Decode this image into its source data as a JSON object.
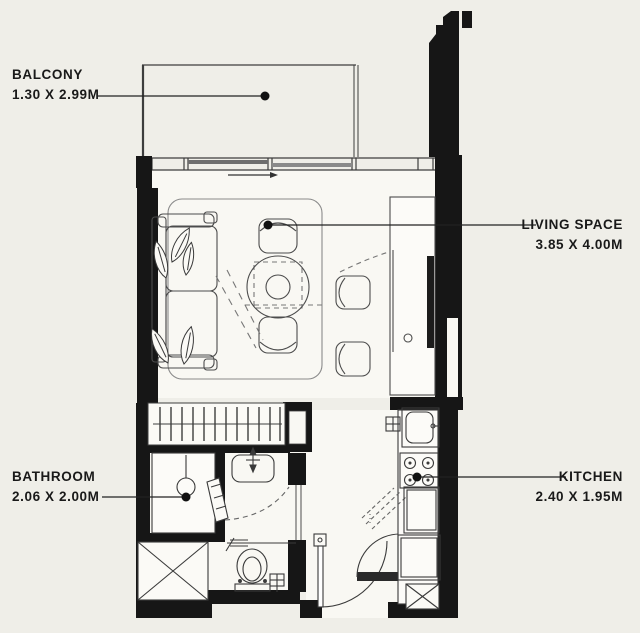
{
  "plan_title": "Studio apartment floor plan",
  "colors": {
    "background": "#efeee8",
    "floor": "#f9f8f3",
    "wall": "#161616",
    "furniture_line": "#4c4c4c",
    "text_ink": "#191919"
  },
  "rooms": {
    "balcony": {
      "name": "BALCONY",
      "dimensions": "1.30 X 2.99M"
    },
    "living_space": {
      "name": "LIVING SPACE",
      "dimensions": "3.85 X 4.00M"
    },
    "bathroom": {
      "name": "BATHROOM",
      "dimensions": "2.06 X 2.00M"
    },
    "kitchen": {
      "name": "KITCHEN",
      "dimensions": "2.40 X 1.95M"
    }
  }
}
